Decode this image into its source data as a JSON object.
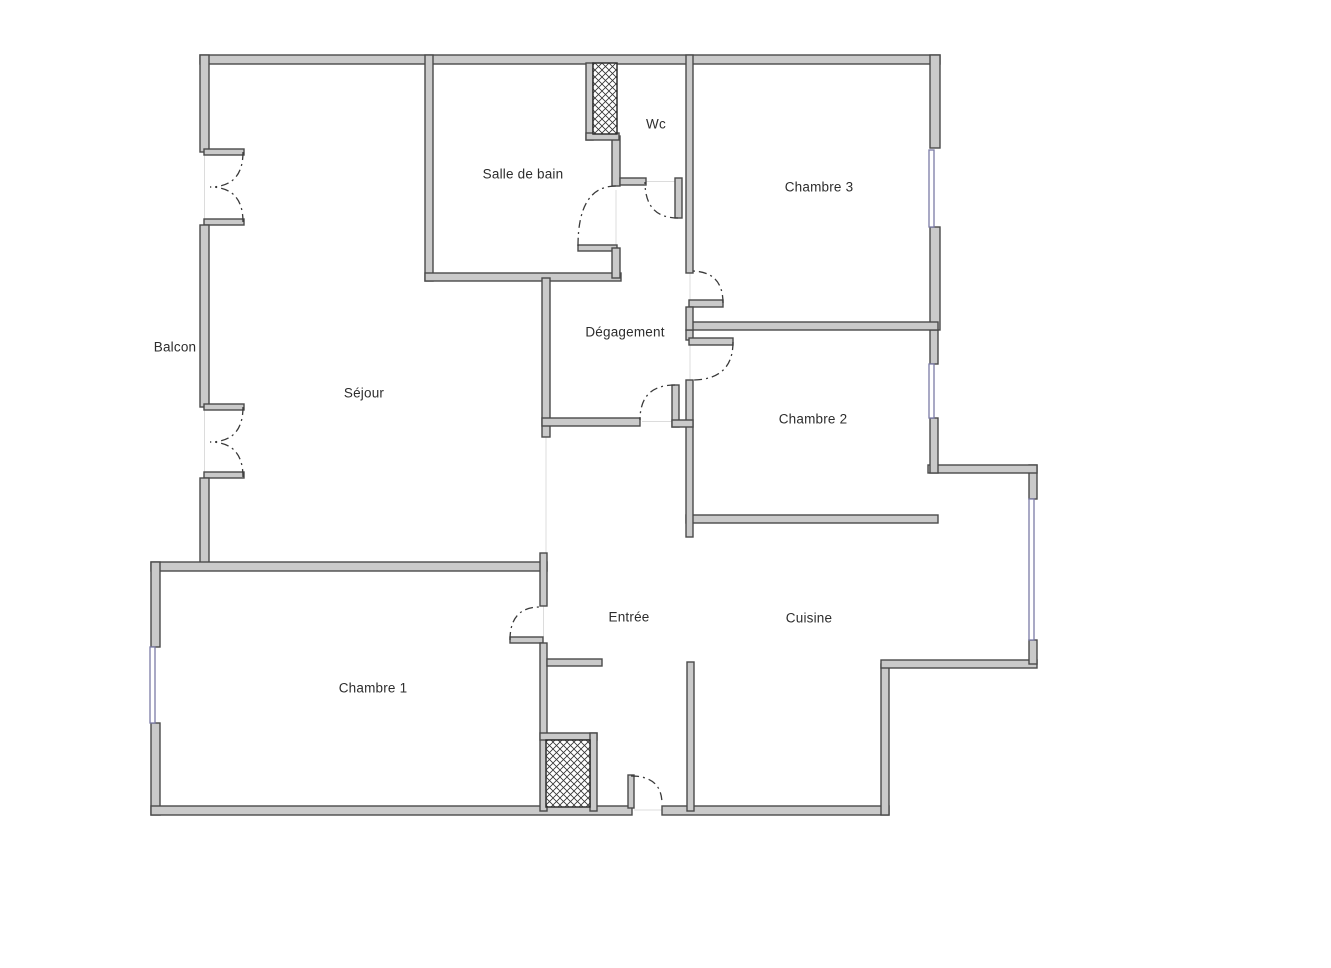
{
  "document": {
    "type": "floor-plan"
  },
  "rooms": [
    {
      "name": "Balcon"
    },
    {
      "name": "Séjour"
    },
    {
      "name": "Salle de bain"
    },
    {
      "name": "Wc"
    },
    {
      "name": "Chambre 3"
    },
    {
      "name": "Dégagement"
    },
    {
      "name": "Chambre 2"
    },
    {
      "name": "Chambre 1"
    },
    {
      "name": "Entrée"
    },
    {
      "name": "Cuisine"
    }
  ],
  "colors": {
    "background": "#ffffff",
    "wall_fill": "#cacaca",
    "wall_stroke": "#4a4a4a",
    "door_arc": "#3a3a3a",
    "window": "#7b7ba6",
    "label_text": "#2d2d2d"
  }
}
